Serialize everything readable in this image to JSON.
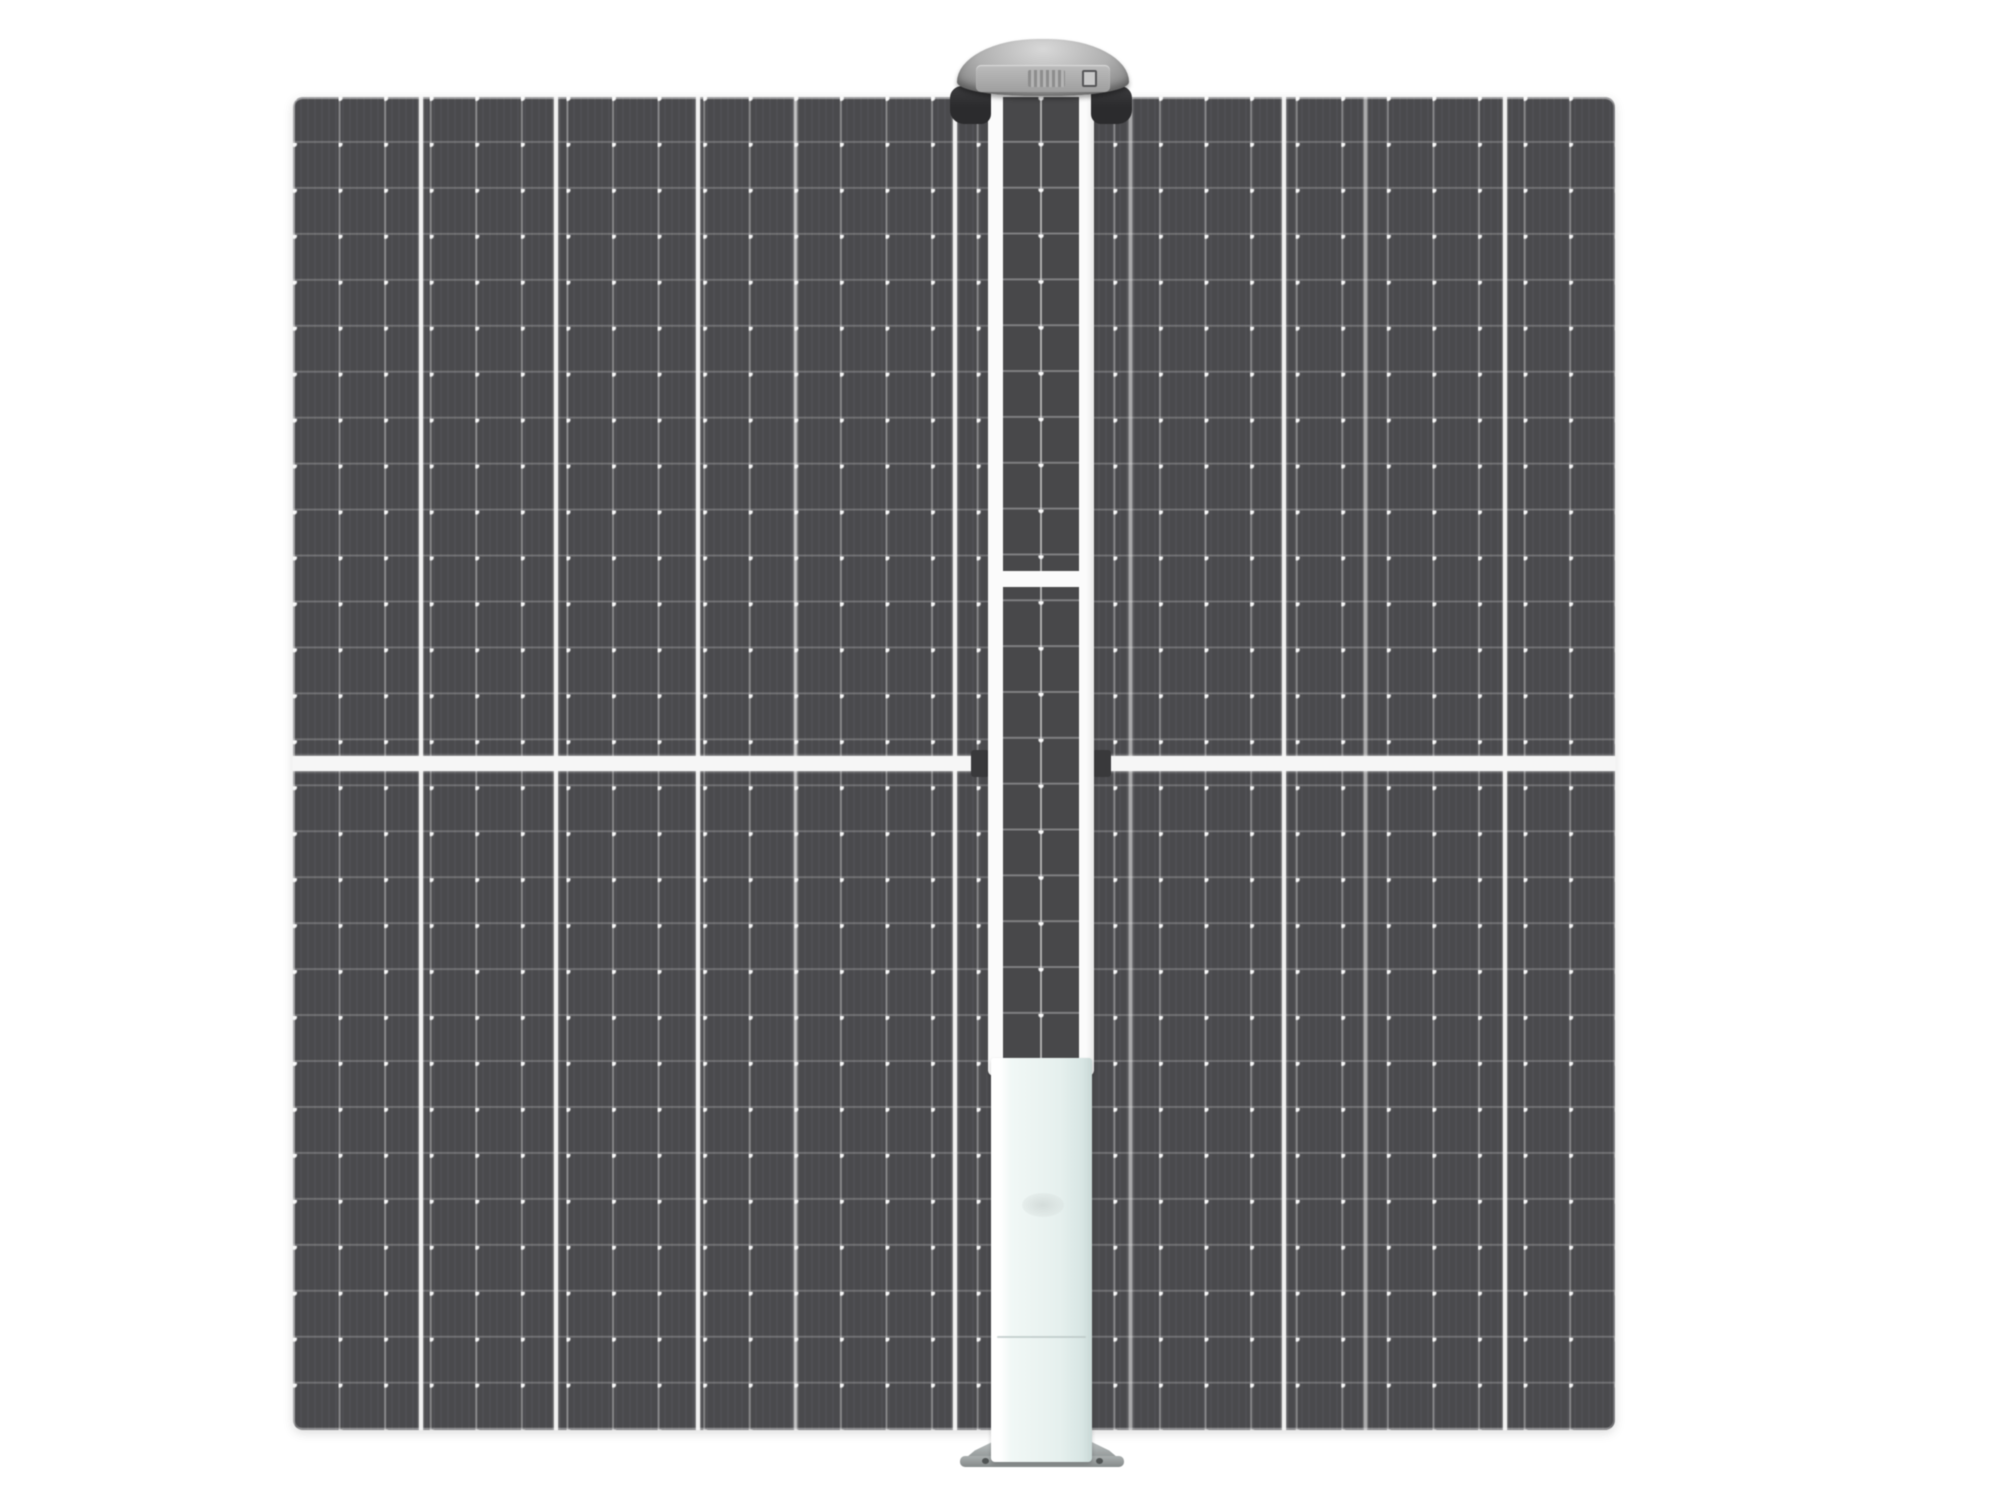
{
  "scene": {
    "kind": "product-photo",
    "subject": "dark solar panel with central pole unit (dome sensor head, thin PV strip, pale battery box, base plate)"
  },
  "canvas": {
    "width": 2000,
    "height": 1500,
    "background": "#ffffff"
  },
  "colors": {
    "panel_cell": "#4a4a4d",
    "panel_cell_texture": "rgba(255,255,255,0.03)",
    "grid_v": "rgba(255,255,255,0.32)",
    "grid_h": "rgba(255,255,255,0.20)",
    "grid_dot": "rgba(255,255,255,0.95)",
    "divider_major": "rgba(250,250,250,0.95)",
    "divider_medium": "rgba(248,248,248,0.55)",
    "mid_band": "#f6f6f6",
    "notch": "#39393b",
    "frame": "#fbfbfb",
    "strip_cell": "#48484a",
    "strip_line": "rgba(255,255,255,0.30)",
    "strip_center": "rgba(255,255,255,0.55)",
    "strip_dot": "rgba(255,255,255,0.95)",
    "dome_light": "#d8d8d8",
    "dome_mid": "#b0b0b0",
    "dome_dark": "#7e7e7e",
    "face_band": "#bcbcbc",
    "clamp": "#2b2b2d",
    "box_light": "#f1f8f6",
    "box_main": "#e6f0ee",
    "box_shade": "#c9d8d6",
    "flange": "#a9aeae",
    "flange_dark": "#868b8b",
    "screw": "#505454",
    "seam": "#b9c6c4",
    "face_mark": "#6a6a6a",
    "face_win_dark": "#3a3a3c",
    "face_win_mid": "#454547"
  },
  "panel_grid": {
    "rows": 29,
    "cols": 29
  },
  "strip_grid": {
    "rows": 21,
    "cols": 2
  },
  "dividers": {
    "major": {
      "width": 4,
      "x": [
        421,
        556,
        698,
        955,
        1284,
        1505
      ]
    },
    "medium": {
      "width": 3,
      "x": [
        795,
        1130,
        1365
      ]
    }
  },
  "parts": {
    "stage": {
      "x": 0,
      "y": 0,
      "w": 2000,
      "h": 1500
    },
    "panel": {
      "x": 293,
      "y": 97,
      "w": 1322,
      "h": 1333
    },
    "band": {
      "x": 293,
      "y": 756,
      "w": 1322,
      "h": 15
    },
    "notch_left": {
      "x": 971,
      "y": 750,
      "w": 18,
      "h": 27
    },
    "notch_right": {
      "x": 1093,
      "y": 750,
      "w": 18,
      "h": 27
    },
    "flange_wings": {
      "x": 960,
      "y": 1437,
      "w": 164,
      "h": 26
    },
    "flange_lip": {
      "x": 960,
      "y": 1456,
      "w": 164,
      "h": 11
    },
    "screw_left": {
      "x": 982,
      "y": 1458,
      "w": 7,
      "h": 6
    },
    "screw_right": {
      "x": 1096,
      "y": 1458,
      "w": 7,
      "h": 6
    },
    "frame": {
      "x": 988,
      "y": 86,
      "w": 106,
      "h": 990
    },
    "strip": {
      "x": 1003,
      "y": 97,
      "w": 76,
      "h": 963
    },
    "strip_divider": {
      "x": 1003,
      "y": 571,
      "w": 76,
      "h": 16
    },
    "box": {
      "x": 991,
      "y": 1058,
      "w": 101,
      "h": 404
    },
    "box_seam": {
      "x": 997,
      "y": 1336,
      "w": 89,
      "h": 2
    },
    "box_logo": {
      "x": 1022,
      "y": 1193,
      "w": 42,
      "h": 24
    },
    "clamp_left": {
      "x": 950,
      "y": 86,
      "w": 41,
      "h": 38
    },
    "clamp_right": {
      "x": 1091,
      "y": 86,
      "w": 41,
      "h": 38
    },
    "dome": {
      "x": 957,
      "y": 39,
      "w": 172,
      "h": 57
    },
    "face": {
      "x": 976,
      "y": 65,
      "w": 134,
      "h": 27
    },
    "face_mark": {
      "x": 988,
      "y": 71,
      "w": 8,
      "h": 13
    },
    "face_win1": {
      "x": 1006,
      "y": 70,
      "w": 17,
      "h": 18
    },
    "face_vent": {
      "x": 1028,
      "y": 70,
      "w": 37,
      "h": 17
    },
    "face_win2": {
      "x": 1066,
      "y": 71,
      "w": 13,
      "h": 16
    },
    "face_win3": {
      "x": 1082,
      "y": 70,
      "w": 15,
      "h": 17
    }
  }
}
